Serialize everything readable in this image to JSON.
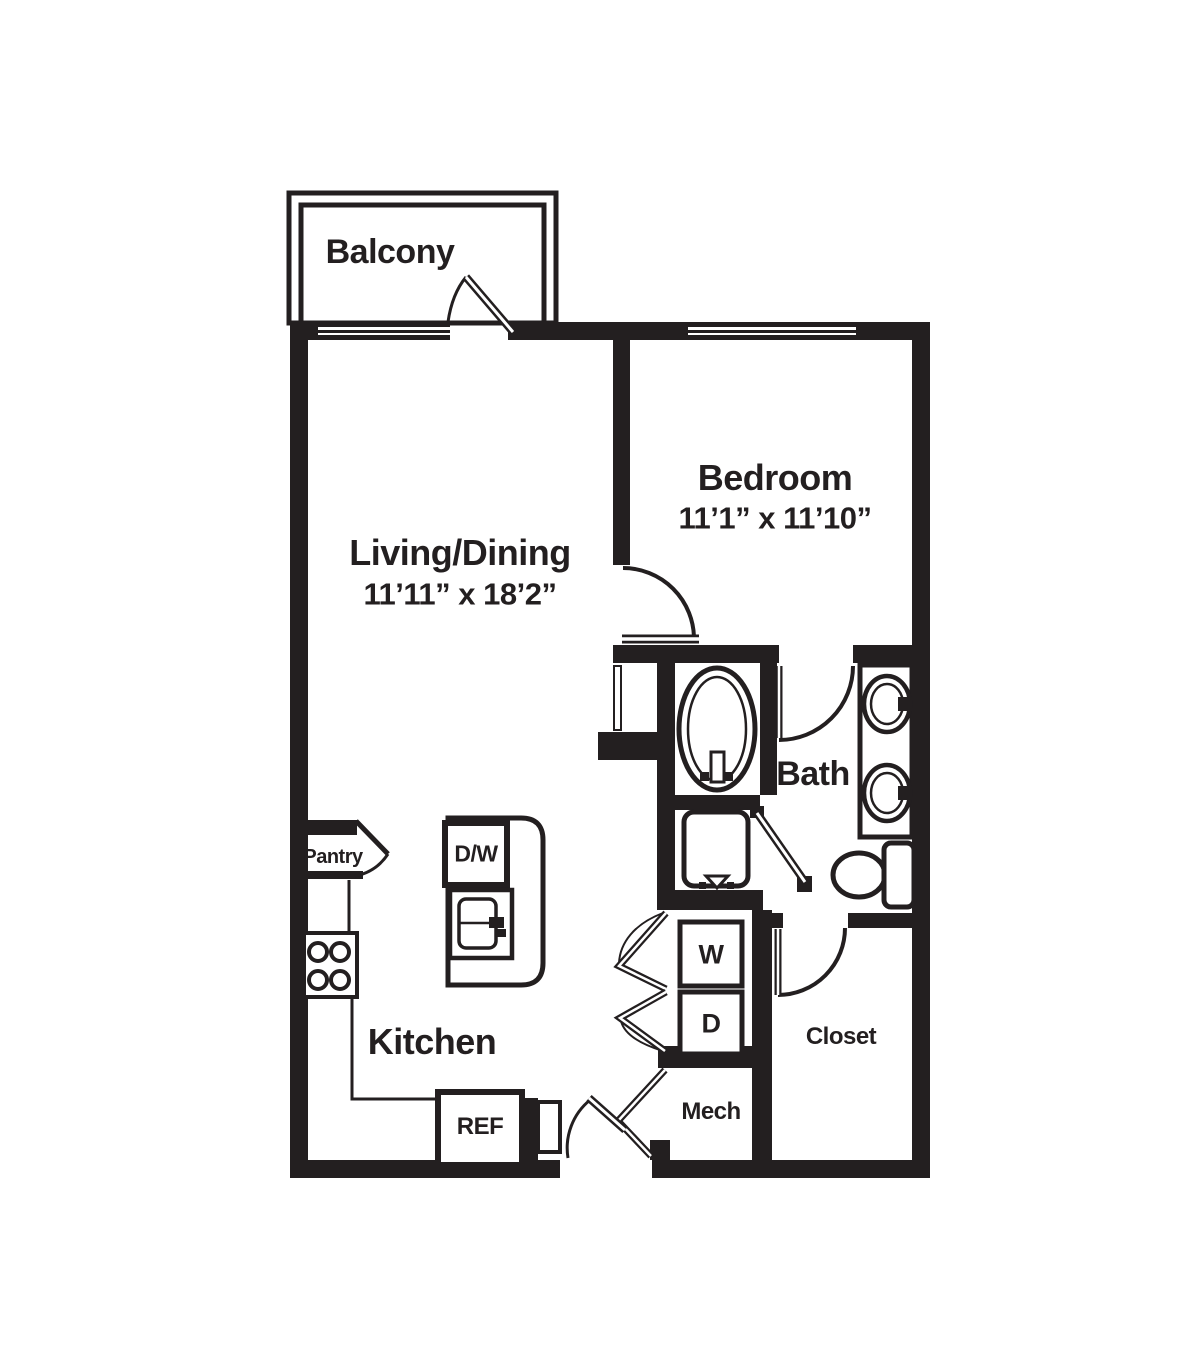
{
  "floorplan": {
    "rooms": {
      "balcony": {
        "label": "Balcony"
      },
      "living_dining": {
        "label": "Living/Dining",
        "dimensions": "11’11” x 18’2”"
      },
      "bedroom": {
        "label": "Bedroom",
        "dimensions": "11’1” x 11’10”"
      },
      "bath": {
        "label": "Bath"
      },
      "kitchen": {
        "label": "Kitchen"
      },
      "pantry": {
        "label": "Pantry"
      },
      "closet": {
        "label": "Closet"
      },
      "mech": {
        "label": "Mech"
      }
    },
    "appliances": {
      "washer": "W",
      "dryer": "D",
      "refrigerator": "REF",
      "dishwasher": "D/W"
    },
    "colors": {
      "wall": "#231f20",
      "background": "#ffffff"
    }
  }
}
